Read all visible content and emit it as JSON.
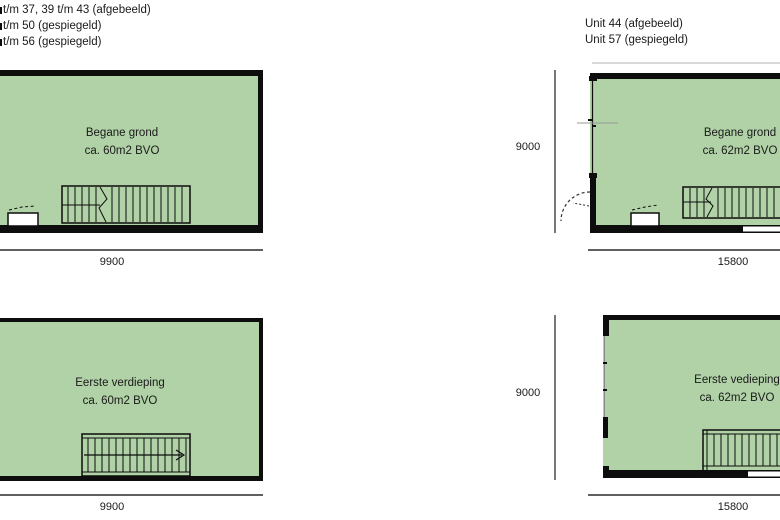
{
  "colors": {
    "room_fill": "#b0d2a6",
    "wall": "#0d0d0d",
    "dim_line": "#4a4a4a",
    "text": "#1a1a1a"
  },
  "legend_left": {
    "line1": "t/m 37, 39 t/m 43 (afgebeeld)",
    "line2": "t/m 50 (gespiegeld)",
    "line3": "t/m 56 (gespiegeld)"
  },
  "legend_right": {
    "line1": "Unit 44 (afgebeeld)",
    "line2": "Unit 57 (gespiegeld)"
  },
  "plans": {
    "ground_left": {
      "title": "Begane grond",
      "area": "ca. 60m2 BVO",
      "width_dim": "9900"
    },
    "ground_right": {
      "title": "Begane grond",
      "area": "ca. 62m2 BVO",
      "width_dim": "15800",
      "height_dim": "9000"
    },
    "first_left": {
      "title": "Eerste verdieping",
      "area": "ca. 60m2 BVO",
      "width_dim": "9900"
    },
    "first_right": {
      "title": "Eerste vedieping",
      "area": "ca. 62m2 BVO",
      "width_dim": "15800",
      "height_dim": "9000"
    }
  }
}
